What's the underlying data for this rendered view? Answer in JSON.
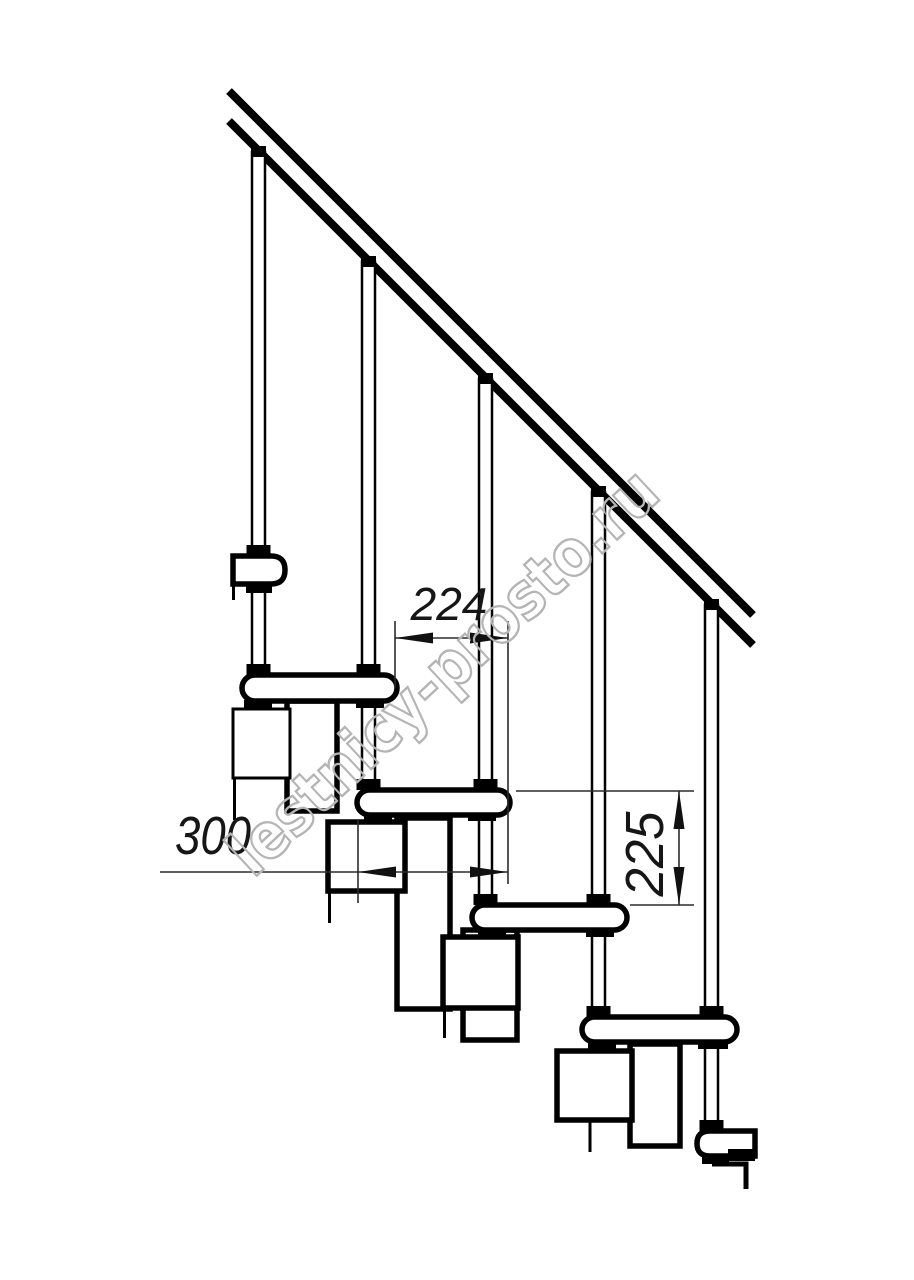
{
  "drawing": {
    "kind": "modular-staircase-side-view",
    "background_color": "#ffffff",
    "line_color": "#000000",
    "dimension_line_color": "#2b2b2b",
    "dimension_labels": {
      "step_run": "224",
      "tread_depth": "300",
      "step_rise": "225"
    },
    "dimension_values": {
      "step_run_mm": 224,
      "tread_depth_mm": 300,
      "step_rise_mm": 225
    },
    "structure": {
      "tread_count_visible": 6,
      "baluster_count": 5,
      "handrail_lines": 2
    },
    "watermark": {
      "text": "lestnicy-prosto.ru",
      "color": "#b4b4b4"
    }
  }
}
